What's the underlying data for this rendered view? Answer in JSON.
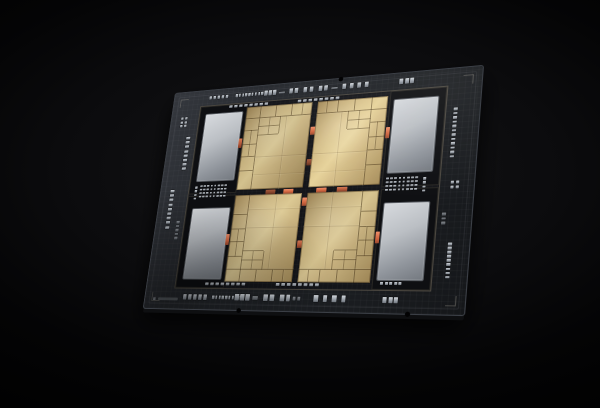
{
  "scene": {
    "description": "Render of a multi-tile server CPU package on a black background",
    "background_color": "#000000"
  },
  "chip": {
    "flat_size": [
      340,
      250
    ],
    "dest_corners": [
      [
        175,
        93
      ],
      [
        482,
        65
      ],
      [
        463,
        314
      ],
      [
        143,
        307
      ]
    ],
    "substrate": {
      "color_light": "#34373d",
      "color_dark": "#15171a",
      "edge_color": "#3c4047",
      "bevel_color": "#0e0f11"
    },
    "frame": {
      "x": 34,
      "y": 18,
      "w": 272,
      "h": 208,
      "line_color": "rgba(205,190,155,0.30)",
      "bg": "#141519"
    },
    "pockets": [
      {
        "x": 35,
        "y": 19,
        "w": 55,
        "h": 101
      },
      {
        "x": 250,
        "y": 19,
        "w": 55,
        "h": 101
      },
      {
        "x": 35,
        "y": 124,
        "w": 55,
        "h": 101
      },
      {
        "x": 250,
        "y": 124,
        "w": 55,
        "h": 101
      }
    ],
    "hbm_dies": [
      {
        "x": 42,
        "y": 28,
        "w": 44,
        "h": 78
      },
      {
        "x": 254,
        "y": 28,
        "w": 44,
        "h": 78
      },
      {
        "x": 42,
        "y": 138,
        "w": 44,
        "h": 78
      },
      {
        "x": 254,
        "y": 138,
        "w": 44,
        "h": 78
      }
    ],
    "tiles": {
      "gold_bright": "#dcc994",
      "gold_mid": "#c4ad79",
      "gold_dark": "#967d50",
      "rects": [
        {
          "x": 92,
          "y": 24,
          "flip": ""
        },
        {
          "x": 173,
          "y": 24,
          "flip": "fx"
        },
        {
          "x": 92,
          "y": 125,
          "flip": "fy"
        },
        {
          "x": 173,
          "y": 125,
          "flip": "fxy"
        }
      ]
    },
    "bridges": {
      "colors": {
        "bright": "linear-gradient(180deg,#f0906a,#d0653f 60%,#9a4a30)",
        "mid": "linear-gradient(180deg,#d57a55,#b25537 60%,#7e3c27)",
        "dark": "linear-gradient(180deg,#a65a3d,#87452c 60%,#5f2f1d)"
      },
      "items": [
        {
          "x": 87,
          "y": 60,
          "w": 4,
          "h": 11,
          "c": "mid"
        },
        {
          "x": 249,
          "y": 58,
          "w": 4,
          "h": 12,
          "c": "bright"
        },
        {
          "x": 87,
          "y": 168,
          "w": 4,
          "h": 12,
          "c": "bright"
        },
        {
          "x": 249,
          "y": 168,
          "w": 4,
          "h": 12,
          "c": "bright"
        },
        {
          "x": 167.5,
          "y": 52,
          "w": 5,
          "h": 9,
          "c": "bright"
        },
        {
          "x": 167.5,
          "y": 88,
          "w": 5,
          "h": 7,
          "c": "dark"
        },
        {
          "x": 126,
          "y": 120,
          "w": 11,
          "h": 5,
          "c": "dark"
        },
        {
          "x": 146,
          "y": 120,
          "w": 11,
          "h": 5,
          "c": "bright"
        },
        {
          "x": 182,
          "y": 120,
          "w": 11,
          "h": 5,
          "c": "bright"
        },
        {
          "x": 204,
          "y": 120,
          "w": 11,
          "h": 5,
          "c": "mid"
        },
        {
          "x": 167.5,
          "y": 130,
          "w": 5,
          "h": 9,
          "c": "bright"
        },
        {
          "x": 167.5,
          "y": 176,
          "w": 5,
          "h": 8,
          "c": "mid"
        }
      ]
    },
    "capacitors": {
      "color": "#b7bcc2",
      "groups": [
        {
          "x": 44,
          "y": 7,
          "dir": "h",
          "n": 5,
          "w": 3,
          "h": 4,
          "gap": 2
        },
        {
          "x": 76,
          "y": 7,
          "dir": "h",
          "n": 9,
          "w": 2.5,
          "h": 4,
          "gap": 1.3
        },
        {
          "x": 110,
          "y": 6,
          "dir": "h",
          "n": 3,
          "w": 3.5,
          "h": 6,
          "gap": 1.5
        },
        {
          "x": 127,
          "y": 9,
          "dir": "h",
          "n": 1,
          "w": 7,
          "h": 2,
          "gap": 0,
          "dim": true
        },
        {
          "x": 139,
          "y": 6,
          "dir": "h",
          "n": 2,
          "w": 4,
          "h": 6,
          "gap": 2
        },
        {
          "x": 155,
          "y": 6,
          "dir": "h",
          "n": 2,
          "w": 4,
          "h": 6,
          "gap": 3
        },
        {
          "x": 172,
          "y": 6,
          "dir": "h",
          "n": 2,
          "w": 4,
          "h": 6,
          "gap": 2
        },
        {
          "x": 186,
          "y": 9,
          "dir": "h",
          "n": 1,
          "w": 7,
          "h": 2,
          "gap": 0,
          "dim": true
        },
        {
          "x": 198,
          "y": 6,
          "dir": "h",
          "n": 4,
          "w": 4,
          "h": 6,
          "gap": 4
        },
        {
          "x": 258,
          "y": 6,
          "dir": "h",
          "n": 3,
          "w": 4,
          "h": 6,
          "gap": 1.5
        },
        {
          "x": 46,
          "y": 234,
          "dir": "h",
          "n": 5,
          "w": 4,
          "h": 6,
          "gap": 2
        },
        {
          "x": 80,
          "y": 235,
          "dir": "h",
          "n": 9,
          "w": 2.5,
          "h": 4,
          "gap": 1.3
        },
        {
          "x": 106,
          "y": 233,
          "dir": "h",
          "n": 3,
          "w": 4.5,
          "h": 7,
          "gap": 1.5
        },
        {
          "x": 126,
          "y": 235,
          "dir": "h",
          "n": 1,
          "w": 6,
          "h": 4,
          "gap": 0,
          "dim": true
        },
        {
          "x": 138,
          "y": 233,
          "dir": "h",
          "n": 2,
          "w": 4.5,
          "h": 7,
          "gap": 2.5
        },
        {
          "x": 156,
          "y": 233,
          "dir": "h",
          "n": 2,
          "w": 4.5,
          "h": 7,
          "gap": 2
        },
        {
          "x": 170,
          "y": 235,
          "dir": "h",
          "n": 2,
          "w": 3,
          "h": 4,
          "gap": 1.5,
          "dim": true
        },
        {
          "x": 192,
          "y": 233,
          "dir": "h",
          "n": 4,
          "w": 4.5,
          "h": 7,
          "gap": 5
        },
        {
          "x": 262,
          "y": 234,
          "dir": "h",
          "n": 3,
          "w": 4,
          "h": 6,
          "gap": 1.5
        },
        {
          "x": 12,
          "y": 30,
          "dir": "grid",
          "cols": 2,
          "rows": 3,
          "w": 3,
          "h": 3,
          "gap": 1.5
        },
        {
          "x": 22,
          "y": 54,
          "dir": "v",
          "n": 8,
          "w": 5,
          "h": 3,
          "gap": 2.2
        },
        {
          "x": 12,
          "y": 116,
          "dir": "v",
          "n": 9,
          "w": 5,
          "h": 3,
          "gap": 2.2
        },
        {
          "x": 25,
          "y": 152,
          "dir": "v",
          "n": 5,
          "w": 4,
          "h": 2.5,
          "gap": 2,
          "dim": true
        },
        {
          "x": 315,
          "y": 42,
          "dir": "v",
          "n": 12,
          "w": 4,
          "h": 2.5,
          "gap": 2
        },
        {
          "x": 318,
          "y": 118,
          "dir": "grid",
          "cols": 2,
          "rows": 2,
          "w": 3,
          "h": 3,
          "gap": 1.5
        },
        {
          "x": 312,
          "y": 150,
          "dir": "v",
          "n": 3,
          "w": 4,
          "h": 2.5,
          "gap": 2,
          "dim": true
        },
        {
          "x": 320,
          "y": 180,
          "dir": "v",
          "n": 9,
          "w": 4,
          "h": 2.5,
          "gap": 1.6
        },
        {
          "x": 70,
          "y": 19.5,
          "dir": "h",
          "n": 8,
          "w": 3.5,
          "h": 3,
          "gap": 2.5
        },
        {
          "x": 150,
          "y": 19.5,
          "dir": "h",
          "n": 8,
          "w": 3.5,
          "h": 3,
          "gap": 2.5
        },
        {
          "x": 70,
          "y": 221,
          "dir": "h",
          "n": 8,
          "w": 3.5,
          "h": 3,
          "gap": 2.5
        },
        {
          "x": 150,
          "y": 221,
          "dir": "h",
          "n": 8,
          "w": 3.5,
          "h": 3,
          "gap": 2.5
        },
        {
          "x": 258,
          "y": 219,
          "dir": "h",
          "n": 5,
          "w": 3,
          "h": 2.5,
          "gap": 1.5
        },
        {
          "x": 48,
          "y": 112,
          "dir": "grid",
          "cols": 8,
          "rows": 4,
          "w": 2.6,
          "h": 2.4,
          "gap": 1.6
        },
        {
          "x": 42,
          "y": 113,
          "dir": "v",
          "n": 4,
          "w": 3,
          "h": 2.5,
          "gap": 1.8
        },
        {
          "x": 254,
          "y": 112,
          "dir": "grid",
          "cols": 8,
          "rows": 4,
          "w": 2.6,
          "h": 2.4,
          "gap": 1.6
        },
        {
          "x": 291,
          "y": 113,
          "dir": "v",
          "n": 4,
          "w": 3,
          "h": 2.5,
          "gap": 1.8
        }
      ]
    },
    "notches": [
      {
        "x": 195,
        "y": 0
      },
      {
        "x": 112,
        "y": 250
      },
      {
        "x": 287,
        "y": 250
      }
    ],
    "marking": {
      "x": 10,
      "y": 236
    }
  }
}
